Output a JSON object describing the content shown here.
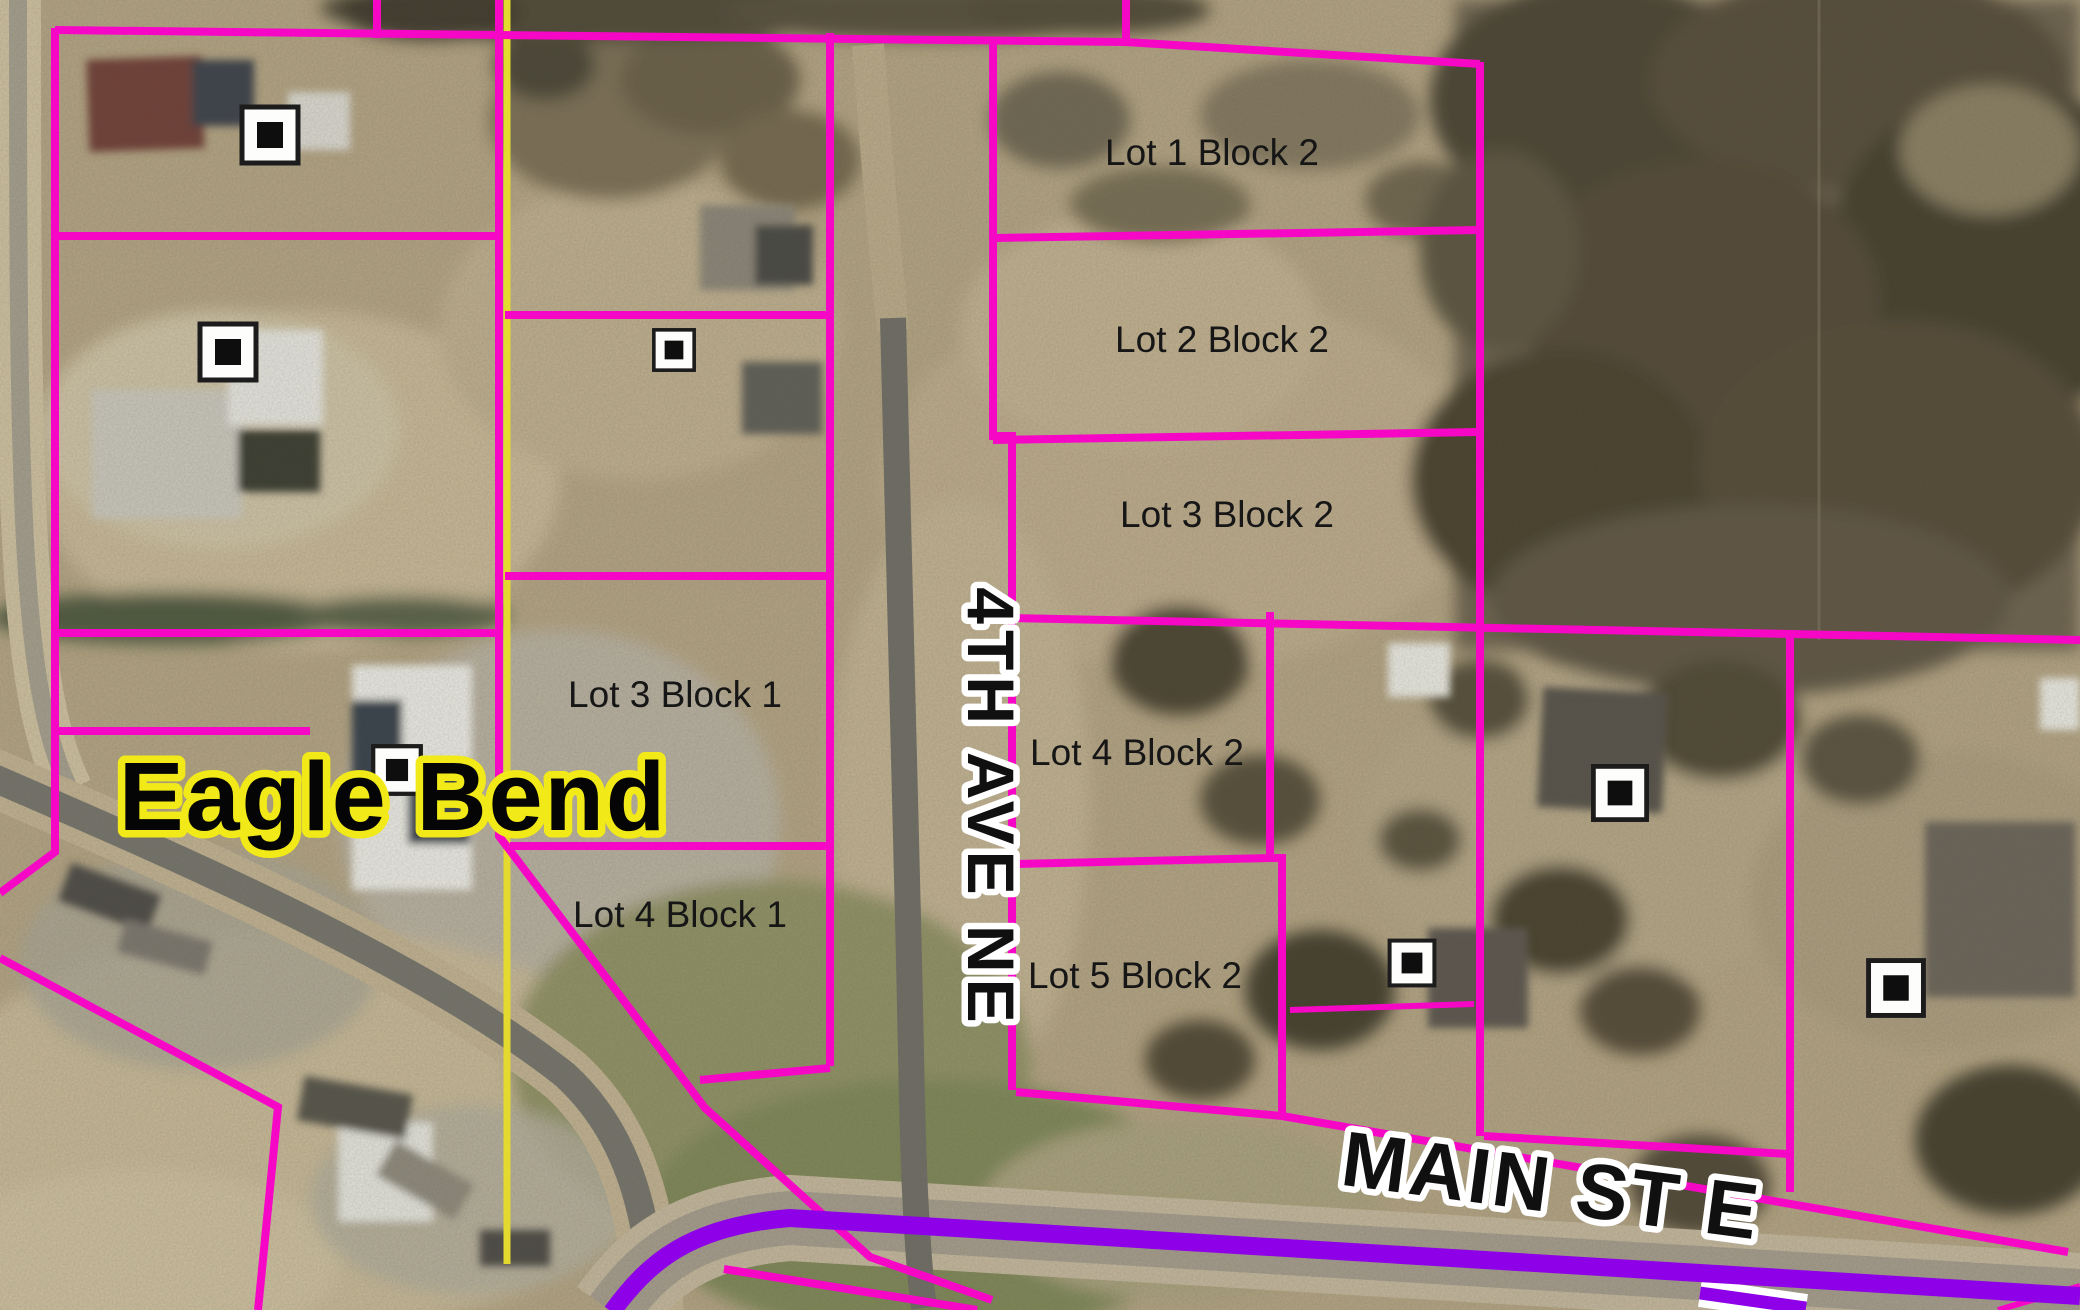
{
  "map": {
    "region_label": "Eagle Bend",
    "streets": {
      "avenue": "4TH AVE NE",
      "main": "MAIN ST E"
    },
    "lot_labels": [
      {
        "text": "Lot 1 Block 2"
      },
      {
        "text": "Lot 2 Block 2"
      },
      {
        "text": "Lot 3 Block 2"
      },
      {
        "text": "Lot 4 Block 2"
      },
      {
        "text": "Lot 5 Block 2"
      },
      {
        "text": "Lot 3 Block 1"
      },
      {
        "text": "Lot 4 Block 1"
      }
    ],
    "icons": {
      "building_marker": "white-square-with-black-center"
    },
    "colors": {
      "parcel_line": "#f607c6",
      "road_centerline": "#8d00e8",
      "city_boundary": "#e3d92f",
      "lot_text": "#161616",
      "street_text": "#101010",
      "street_halo": "#ffffff",
      "town_text": "#050505",
      "town_halo": "#f2ea18"
    }
  }
}
